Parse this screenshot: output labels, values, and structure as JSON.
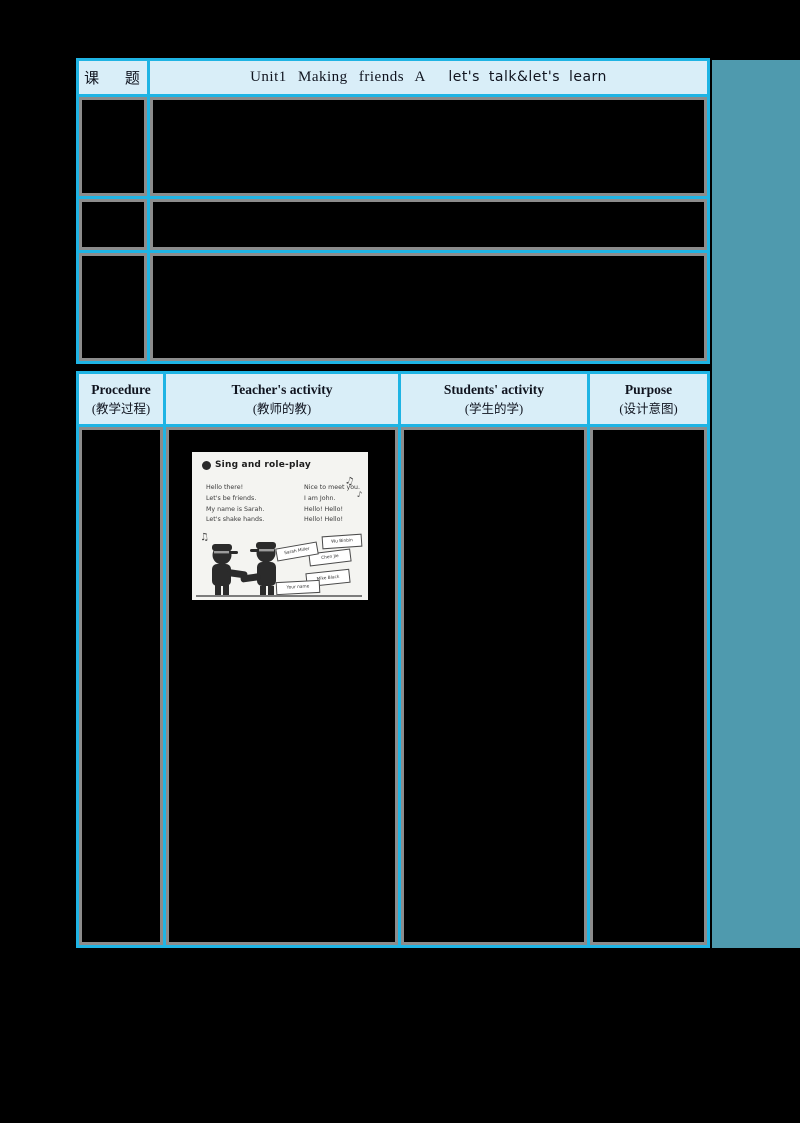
{
  "colors": {
    "canvas_bg": "#000000",
    "accent_cyan": "#1fb4e4",
    "header_cell_bg": "#d9eef8",
    "teal_panel": "#4f9aae",
    "cell_outline_gray": "#8c8c8c",
    "redacted_cell_bg": "#000000"
  },
  "lesson_table": {
    "topic_label": "课 题",
    "title_main": "Unit1 Making friends A",
    "title_sub": "let's talk&let's learn"
  },
  "procedure_table": {
    "headers": [
      {
        "en": "Procedure",
        "zh": "(教学过程)"
      },
      {
        "en": "Teacher's activity",
        "zh": "(教师的教)"
      },
      {
        "en": "Students' activity",
        "zh": "(学生的学)"
      },
      {
        "en": "Purpose",
        "zh": "(设计意图)"
      }
    ]
  },
  "textbook_image": {
    "title": "Sing and role-play",
    "lyrics_left": [
      "Hello there!",
      "Let's be friends.",
      "My name is Sarah.",
      "Let's shake hands."
    ],
    "lyrics_right": [
      "Nice to meet you.",
      "I am John.",
      "Hello! Hello!",
      "Hello! Hello!"
    ],
    "name_cards": [
      "Wu Binbin",
      "Chen Jie",
      "Sarah Miller",
      "Mike Black",
      "Your name"
    ],
    "music_note_double": "♫",
    "music_note_single": "♪"
  }
}
